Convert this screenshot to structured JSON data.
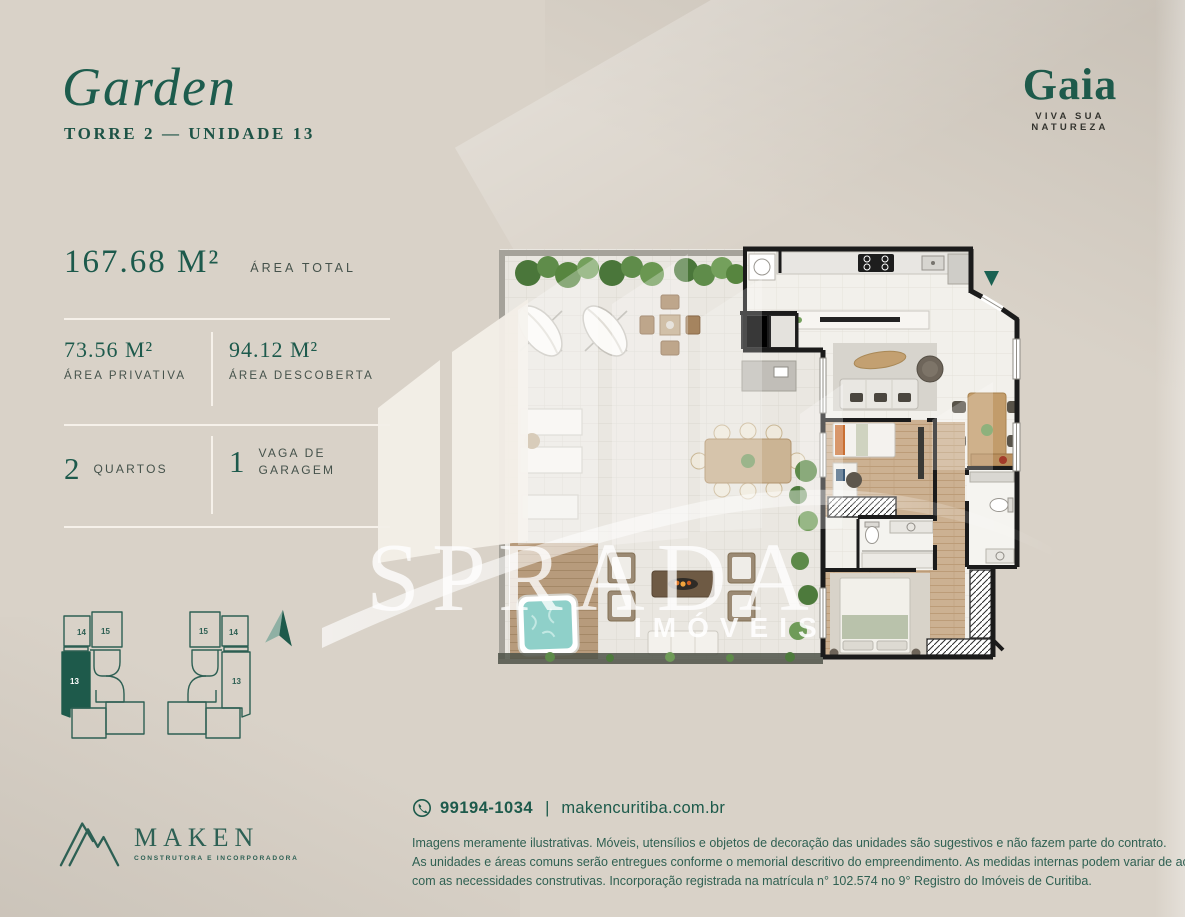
{
  "header": {
    "title": "Garden",
    "subtitle": "TORRE 2 — UNIDADE 13"
  },
  "brand": {
    "name": "Gaia",
    "tagline": "VIVA SUA NATUREZA"
  },
  "specs": {
    "total": {
      "value": "167.68 M²",
      "label": "ÁREA TOTAL"
    },
    "privativa": {
      "value": "73.56 M²",
      "label": "ÁREA PRIVATIVA"
    },
    "descoberta": {
      "value": "94.12 M²",
      "label": "ÁREA DESCOBERTA"
    },
    "quartos": {
      "value": "2",
      "label": "QUARTOS"
    },
    "vaga": {
      "value": "1",
      "label_line1": "VAGA DE",
      "label_line2": "GARAGEM"
    }
  },
  "keyplan": {
    "left": {
      "top1": "14",
      "top2": "15",
      "unit": "13"
    },
    "right": {
      "top1": "15",
      "top2": "14",
      "unit": "13"
    },
    "highlighted_unit": "13"
  },
  "watermark": {
    "name": "SPRADA",
    "subname": "IMÓVEIS"
  },
  "developer": {
    "name": "MAKEN",
    "tagline": "CONSTRUTORA E INCORPORADORA"
  },
  "contact": {
    "phone": "99194-1034",
    "separator": "|",
    "website": "makencuritiba.com.br"
  },
  "disclaimer": {
    "line1": "Imagens meramente ilustrativas. Móveis, utensílios e objetos de decoração das unidades são sugestivos e não fazem parte do contrato.",
    "line2": "As unidades e áreas comuns serão entregues conforme o memorial descritivo do empreendimento. As medidas internas podem variar de acordo",
    "line3": "com as necessidades construtivas. Incorporação registrada na matrícula n° 102.574 no 9° Registro do Imóveis de Curitiba."
  },
  "colors": {
    "accent": "#1E5A4B",
    "background": "#D9D2C8",
    "label": "#45524B",
    "wall": "#1B1B1B",
    "watermark": "#FFFFFF"
  }
}
